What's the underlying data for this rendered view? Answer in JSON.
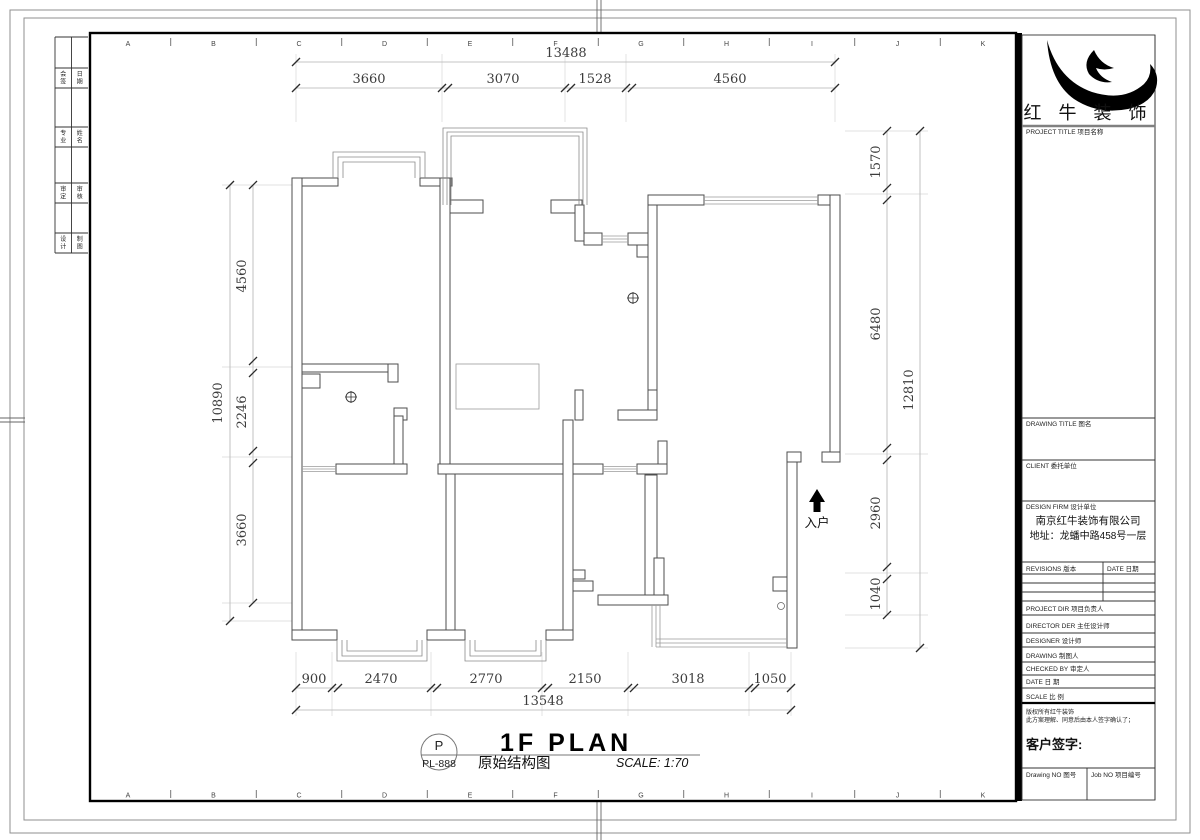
{
  "sheet": {
    "ruler_letters": [
      "A",
      "B",
      "C",
      "D",
      "E",
      "F",
      "G",
      "H",
      "I",
      "J",
      "K"
    ],
    "side_cells": [
      [
        "会签",
        "日期"
      ],
      [
        "专业",
        "姓名"
      ],
      [
        "审定",
        "审核"
      ],
      [
        "设计",
        "制图"
      ]
    ]
  },
  "plan": {
    "entry_label": "入户",
    "stamp": {
      "letter": "P",
      "code": "PL-888"
    },
    "title": "1F PLAN",
    "subtitle": "原始结构图",
    "scale_text": "SCALE: 1:70"
  },
  "dimensions": {
    "top": {
      "total": "13488",
      "segments": [
        "3660",
        "3070",
        "1528",
        "4560"
      ]
    },
    "bottom": {
      "total": "13548",
      "segments": [
        "900",
        "2470",
        "2770",
        "2150",
        "3018",
        "1050"
      ]
    },
    "left": {
      "total": "10890",
      "segments": [
        "4560",
        "2246",
        "3660"
      ]
    },
    "right": {
      "total": "12810",
      "segments": [
        "1570",
        "6480",
        "2960",
        "1040"
      ]
    }
  },
  "titleblock": {
    "brand": "红 牛 装 饰",
    "project_title": "PROJECT TITLE  项目名称",
    "drawing_title": "DRAWING TITLE  图名",
    "client": "CLIENT  委托单位",
    "design_firm": "DESIGN FIRM  设计单位",
    "company_name": "南京红牛装饰有限公司",
    "company_addr": "地址：龙蟠中路458号一层",
    "revisions": "REVISIONS  版本",
    "date_col": "DATE  日期",
    "project_dir": "PROJECT DIR  项目负责人",
    "director": "DIRECTOR DER  主任设计师",
    "designer": "DESIGNER    设计师",
    "drawing_by": "DRAWING    制图人",
    "checked_by": "CHECKED BY   审定人",
    "date_row": "DATE      日  期",
    "scale_row": "SCALE      比  例",
    "notice_1": "版权所有红牛装饰",
    "notice_2": "此方案理解、同意后由本人签字确认了；",
    "client_sign": "客户签字:",
    "drawing_no": "Drawing NO  图号",
    "job_no": "Job NO  项目编号"
  },
  "colors": {
    "wall": "#4d4d4d",
    "logo": "#000000",
    "frame": "#000000"
  }
}
